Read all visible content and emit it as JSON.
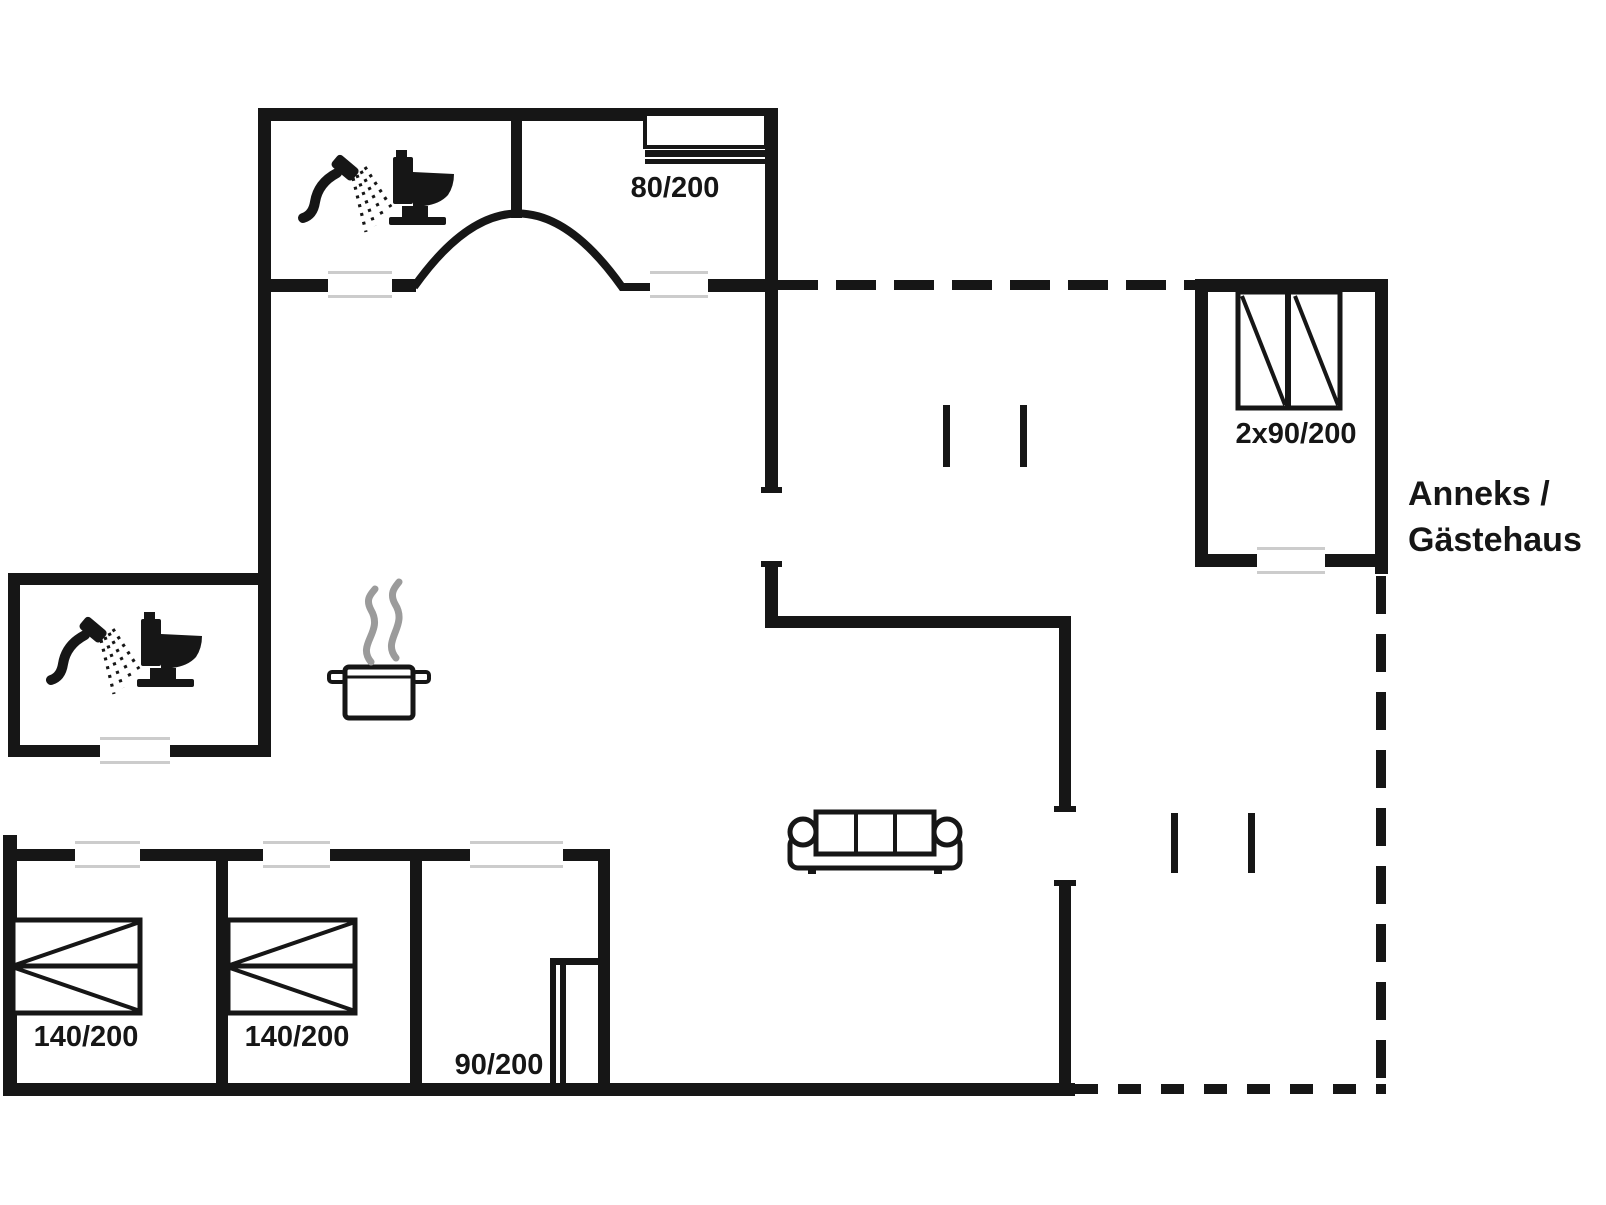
{
  "floorplan": {
    "background_color": "#ffffff",
    "wall_color": "#161616",
    "door_line_color": "#cccccc",
    "steam_color": "#9b9b9b",
    "labels": {
      "bed_top_bedroom": "80/200",
      "bed_annex": "2x90/200",
      "annex_name_line1": "Anneks /",
      "annex_name_line2": "Gästehaus",
      "bed_room1": "140/200",
      "bed_room2": "140/200",
      "bed_room3": "90/200"
    },
    "icons": {
      "bathroom_top": [
        "shower-icon",
        "toilet-icon"
      ],
      "bathroom_middle": [
        "shower-icon",
        "toilet-icon"
      ],
      "kitchen": [
        "cooking-pot-icon",
        "steam-icon"
      ],
      "living_room": [
        "sofa-icon"
      ]
    }
  }
}
